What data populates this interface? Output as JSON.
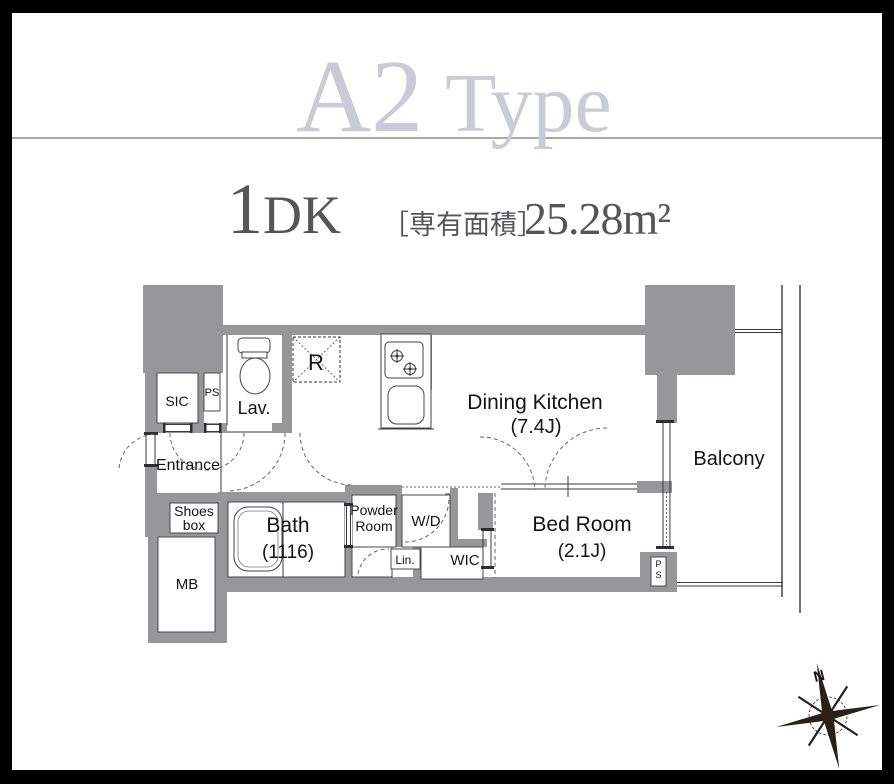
{
  "header": {
    "type_name": "A2",
    "type_suffix": "Type",
    "plan_number": "1",
    "plan_suffix": "DK",
    "area_label": "［専有面積］",
    "area_value": "25.28m²"
  },
  "plan": {
    "rooms": {
      "sic": "SIC",
      "ps_upper": "PS",
      "lav": "Lav.",
      "fridge": "R",
      "dining_kitchen": "Dining Kitchen",
      "dining_kitchen_size": "(7.4J)",
      "balcony": "Balcony",
      "entrance": "Entrance",
      "shoes_line1": "Shoes",
      "shoes_line2": "box",
      "mb": "MB",
      "bath": "Bath",
      "bath_size": "(1116)",
      "powder_line1": "Powder",
      "powder_line2": "Room",
      "wd": "W/D",
      "lin": "Lin.",
      "wic": "WIC",
      "bedroom": "Bed Room",
      "bedroom_size": "(2.1J)",
      "ps_lower_p": "P",
      "ps_lower_s": "S"
    },
    "compass_label": "N",
    "icons": {
      "toilet": "toilet-icon",
      "stove": "stove-burners-icon",
      "sink": "kitchen-sink-icon",
      "bathtub": "bathtub-icon",
      "fridge_space": "refrigerator-space-icon",
      "compass": "compass-rose-icon"
    },
    "colors": {
      "wall_gray": "#97979a",
      "title_gray": "#c7ccd6",
      "subtitle_gray": "#55565a",
      "line_dark": "#3a3a3a",
      "compass_dark": "#2b2017"
    }
  }
}
